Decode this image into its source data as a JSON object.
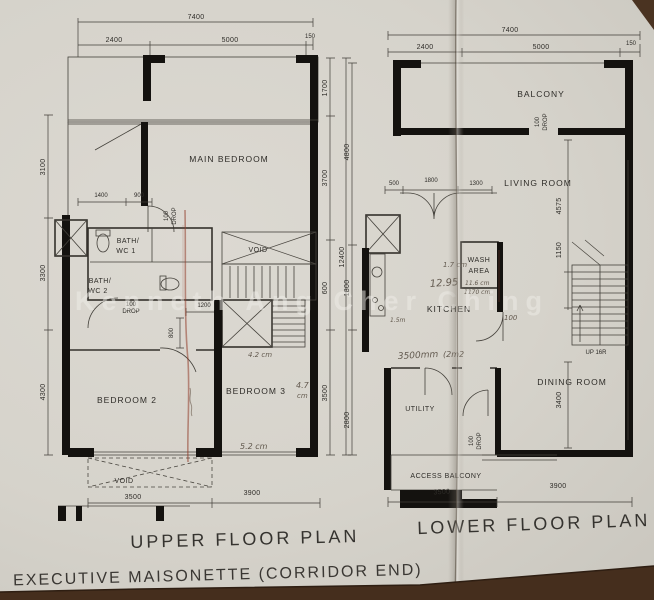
{
  "watermark": "Kenneth Ang Cher Ching",
  "footer": {
    "subtitle": "EXECUTIVE  MAISONETTE  (CORRIDOR  END)"
  },
  "upper": {
    "title": "UPPER  FLOOR  PLAN",
    "rooms": {
      "main_bedroom": "MAIN  BEDROOM",
      "bath1_l1": "BATH/",
      "bath1_l2": "WC 1",
      "bath2_l1": "BATH/",
      "bath2_l2": "WC 2",
      "bedroom2": "BEDROOM  2",
      "bedroom3": "BEDROOM  3",
      "void_mid": "VOID",
      "void_bottom": "VOID"
    },
    "dims": {
      "top_total": "7400",
      "top_a": "2400",
      "top_b": "5000",
      "top_c": "150",
      "left_a": "3100",
      "left_b": "3300",
      "left_c": "4300",
      "right_a": "1700",
      "right_b": "3700",
      "right_c": "600",
      "right_d": "3500",
      "right_total": "12400",
      "bath_a": "1400",
      "bath_b": "900",
      "stair": "1200",
      "door": "800",
      "drop1_l1": "100",
      "drop1_l2": "DROP",
      "drop2_l1": "100",
      "drop2_l2": "DROP",
      "bottom_a": "3500",
      "bottom_b": "3900"
    },
    "notes": {
      "n1": "4.7",
      "n1b": "cm",
      "n2": "5.2 cm",
      "n3": "4.2 cm"
    }
  },
  "lower": {
    "title": "LOWER  FLOOR  PLAN",
    "rooms": {
      "balcony": "BALCONY",
      "living": "LIVING  ROOM",
      "wash_l1": "WASH",
      "wash_l2": "AREA",
      "kitchen": "KITCHEN",
      "dining": "DINING  ROOM",
      "utility": "UTILITY",
      "access_balcony": "ACCESS  BALCONY",
      "stairs": "UP 16R"
    },
    "dims": {
      "top_total": "7400",
      "top_a": "2400",
      "top_b": "5000",
      "top_c": "150",
      "left_a": "4800",
      "left_b": "1800",
      "left_c": "2800",
      "entry_a": "500",
      "entry_b": "1800",
      "entry_c": "1300",
      "right_a": "4575",
      "right_b": "1150",
      "right_c": "3400",
      "drop_balcony_l1": "100",
      "drop_balcony_l2": "DROP",
      "drop_utility_l1": "100",
      "drop_utility_l2": "DROP",
      "bottom_a": "3500",
      "bottom_b": "3900"
    },
    "notes": {
      "n1": "1.7 cm",
      "n2": "12.95",
      "n3": "11.6 cm",
      "n4": "1170 cm",
      "n5": "100",
      "n6": "3500mm",
      "n7": "(2m2",
      "n8": "1.5m"
    }
  }
}
